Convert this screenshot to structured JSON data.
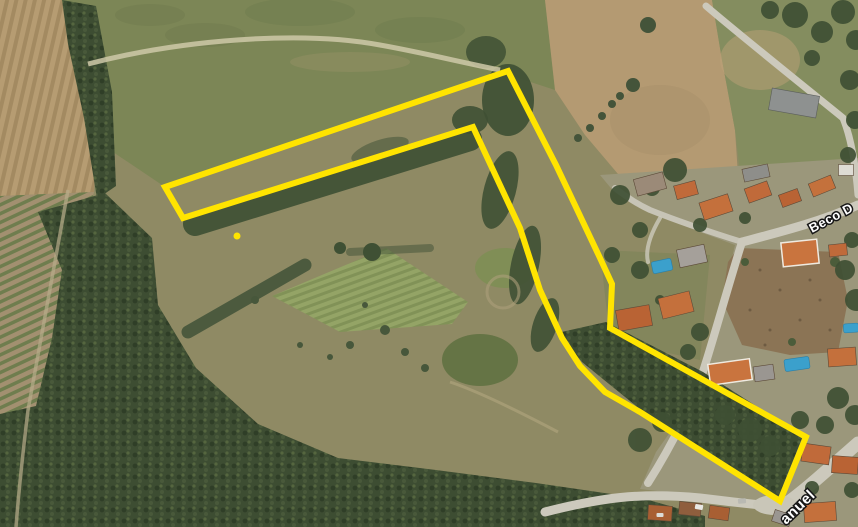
{
  "map": {
    "view": "satellite",
    "street_labels": [
      {
        "text": "Beco D"
      },
      {
        "text": "anuel"
      }
    ],
    "overlay": {
      "color": "#FFE400",
      "stroke_width": 6,
      "outline_points": [
        [
          165,
          187
        ],
        [
          508,
          71
        ],
        [
          556,
          165
        ],
        [
          600,
          258
        ],
        [
          612,
          284
        ],
        [
          610,
          328
        ],
        [
          806,
          437
        ],
        [
          780,
          501
        ],
        [
          640,
          412
        ],
        [
          605,
          392
        ],
        [
          580,
          366
        ],
        [
          562,
          338
        ],
        [
          540,
          290
        ],
        [
          520,
          228
        ],
        [
          473,
          127
        ],
        [
          183,
          218
        ]
      ],
      "marker_dot": {
        "x": 237,
        "y": 236,
        "r": 3.5
      }
    },
    "terrain_colors": {
      "scrub": "#8f8a64",
      "meadow": "#7c8656",
      "plowed_field": "#b49a72",
      "forest": "#3d4d32",
      "road": "#ccc9bc",
      "roof_orange": "#c4703c",
      "pool": "#3ba0cc"
    }
  }
}
